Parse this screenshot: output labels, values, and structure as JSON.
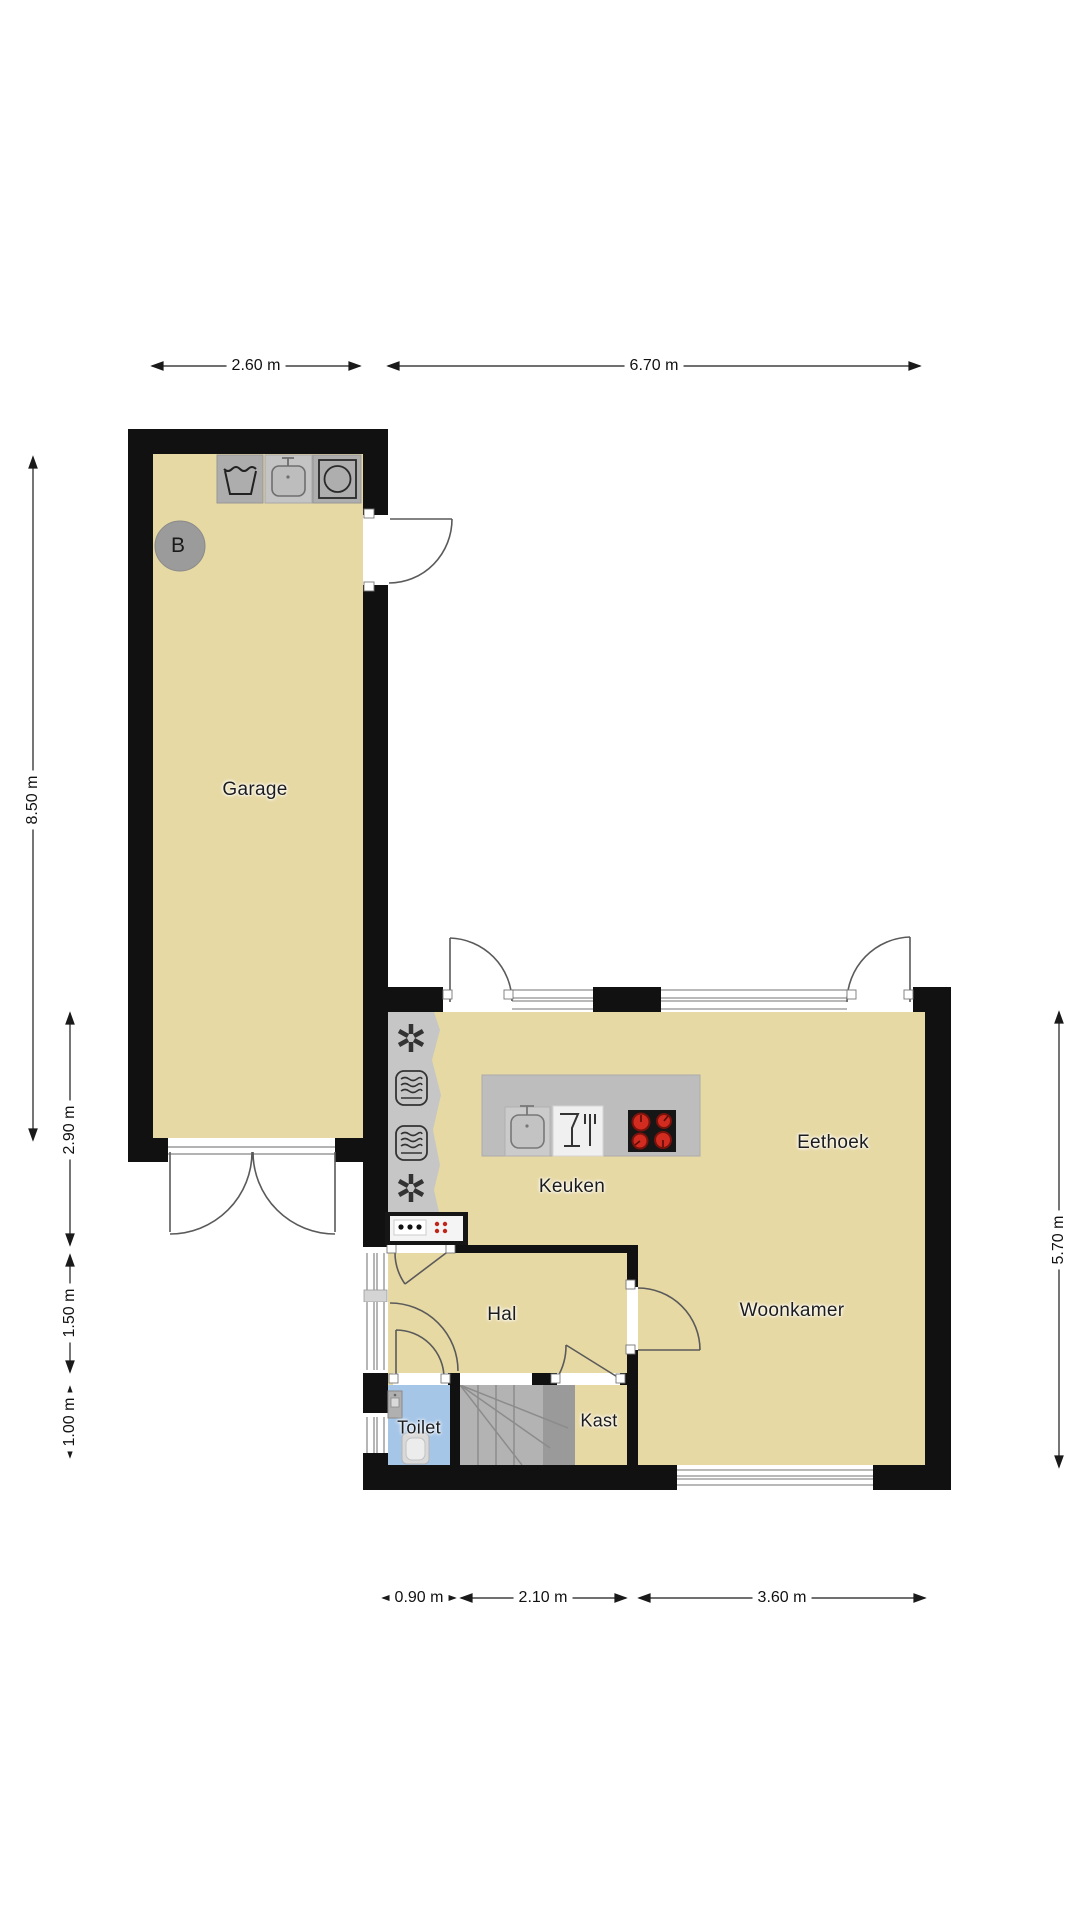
{
  "rooms": {
    "garage": "Garage",
    "keuken": "Keuken",
    "eethoek": "Eethoek",
    "woonkamer": "Woonkamer",
    "hal": "Hal",
    "toilet": "Toilet",
    "kast": "Kast"
  },
  "marker": {
    "label": "B"
  },
  "dimensions": {
    "top": [
      "2.60 m",
      "6.70 m"
    ],
    "left": [
      "8.50 m",
      "2.90 m",
      "1.50 m",
      "1.00 m"
    ],
    "right": [
      "5.70 m"
    ],
    "bottom": [
      "0.90 m",
      "2.10 m",
      "3.60 m"
    ]
  },
  "icons": [
    "washtub-icon",
    "laundry-sink-icon",
    "washing-machine-icon",
    "fan-icon",
    "radiator-icon",
    "kitchen-sink-icon",
    "dishwasher-safe-icon",
    "cooktop-icon",
    "boiler-icon",
    "toilet-icon",
    "hand-sink-icon"
  ],
  "colors": {
    "wall": "#111111",
    "floor": "#e7d9a4",
    "toilet_floor": "#a6c6e8",
    "stairs": "#b3b3b3",
    "counter": "#bdbdbd",
    "fixture_gray": "#c6c6c6",
    "burner_red": "#d22b1f",
    "background": "#ffffff"
  }
}
